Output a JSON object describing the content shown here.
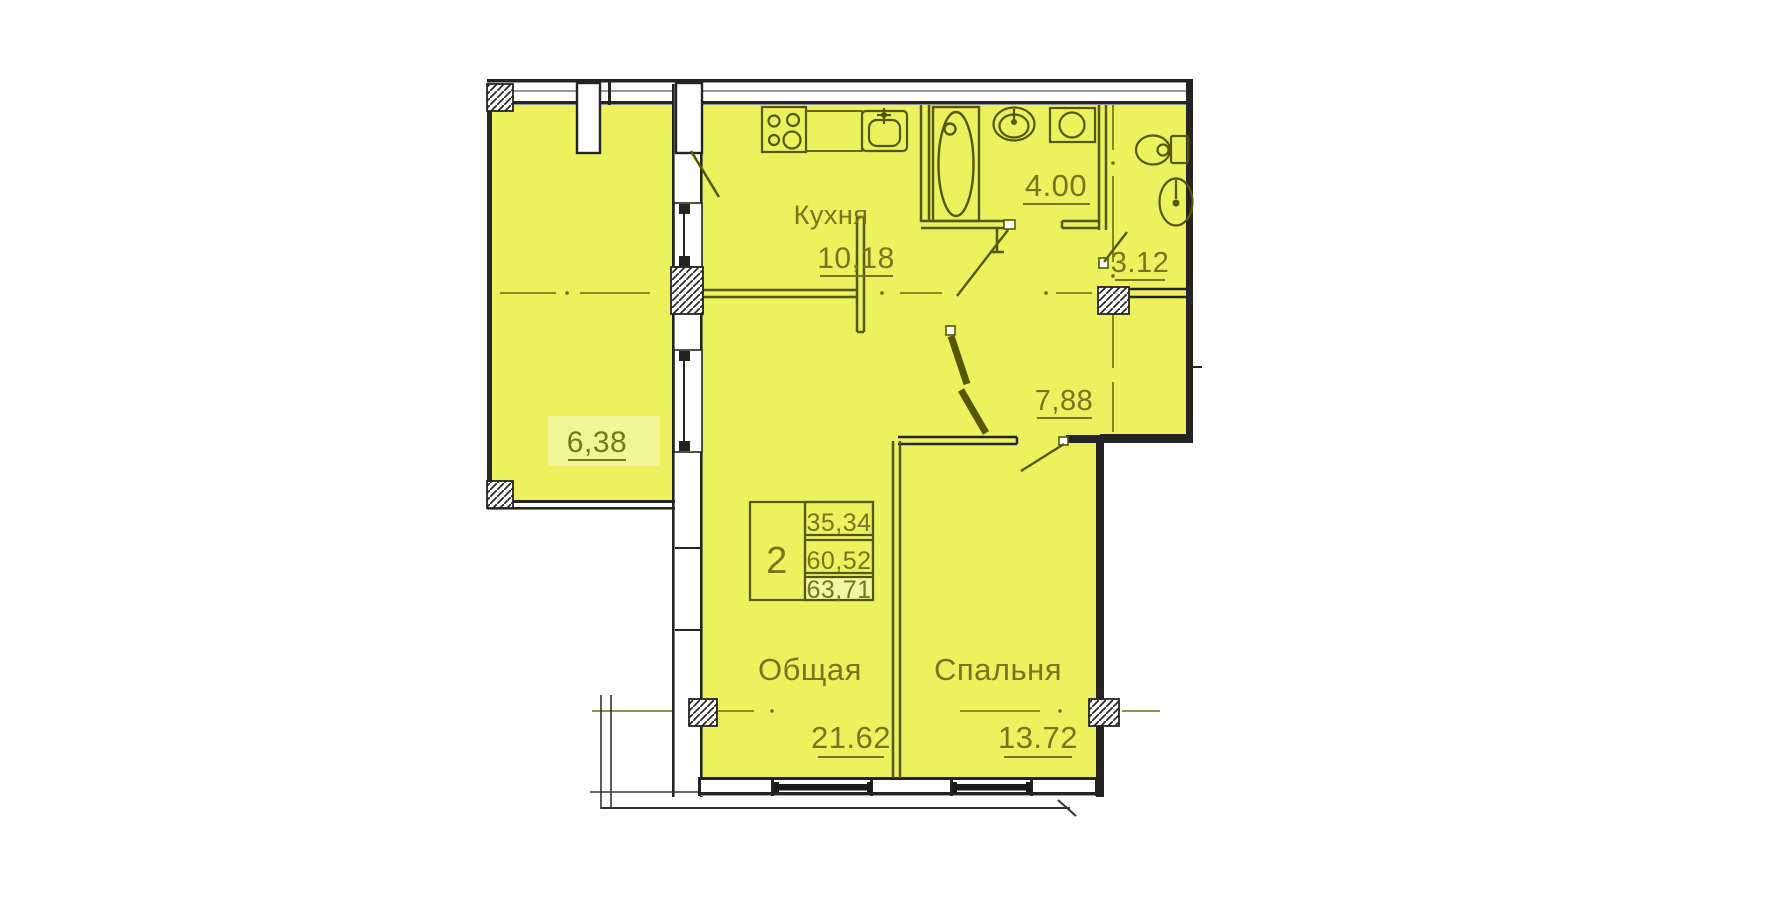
{
  "colors": {
    "room_fill": "#edf15e",
    "highlight_fill": "#f3f6a8",
    "interior_line": "#565800",
    "label_text": "#75771e",
    "outer_wall": "#242424"
  },
  "plan": {
    "rooms": {
      "kitchen": {
        "label": "Кухня",
        "area": "10,18"
      },
      "bathroom": {
        "area": "4.00"
      },
      "wc": {
        "area": "3.12"
      },
      "hall": {
        "area": "7,88"
      },
      "loggia": {
        "area": "6,38"
      },
      "living": {
        "label": "Общая",
        "area": "21.62"
      },
      "bedroom": {
        "label": "Спальня",
        "area": "13.72"
      }
    },
    "info_table": {
      "rooms_count": "2",
      "rows": [
        "35,34",
        "60,52",
        "63,71"
      ]
    }
  }
}
